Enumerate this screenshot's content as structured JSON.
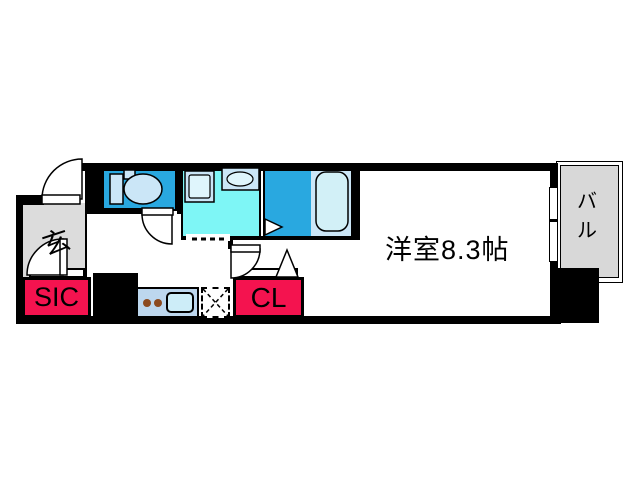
{
  "floorplan": {
    "type": "apartment-floor-plan",
    "labels": {
      "entrance": "玄",
      "shoe_closet": "SIC",
      "closet": "CL",
      "main_room": "洋室8.3帖",
      "balcony_char_1": "バ",
      "balcony_char_2": "ル"
    },
    "colors": {
      "wall": "#000000",
      "wet_area_blue": "#29A8E0",
      "washroom_cyan": "#7EF6F6",
      "fixture_light_blue": "#CBE6F7",
      "fixture_inner": "#DFF5FC",
      "bathtub_fill": "#D2F0F7",
      "kitchen_counter": "#BDD7EE",
      "kitchen_sink": "#CDEDF8",
      "burner_brown": "#8C4A1F",
      "accent_red": "#F4134F",
      "entrance_gray": "#DCDCDC",
      "balcony_gray": "#D8D8D8"
    },
    "icons": [
      "toilet-icon",
      "washing-machine-pan-icon",
      "washbasin-icon",
      "bathtub-icon",
      "stove-burners-icon",
      "kitchen-sink-icon",
      "refrigerator-space-icon",
      "door-swing-icon",
      "folding-door-icon",
      "sliding-window-icon"
    ]
  }
}
